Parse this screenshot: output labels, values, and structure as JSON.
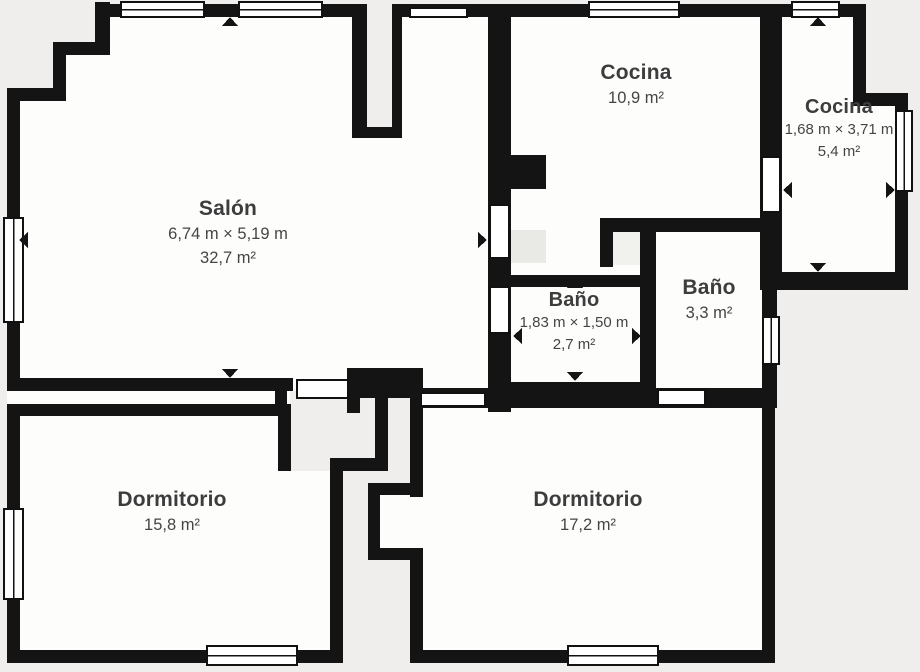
{
  "plan": {
    "title": "Floor plan",
    "background": "#efeeec",
    "room_fill": "#fdfdfc",
    "wall_color": "#141414",
    "door_fill": "#ffffff",
    "window_fill": "#ffffff",
    "outline_color": "#111111",
    "text_color": "#3d3d3d",
    "swing_fill": "#e9e9e6",
    "niche_fill": "#efeeec",
    "rooms": [
      {
        "key": "salon",
        "name": "Salón",
        "dims": "6,74 m × 5,19 m",
        "area": "32,7 m²",
        "x": 228,
        "y": 196,
        "small": false
      },
      {
        "key": "cocina-main",
        "name": "Cocina",
        "dims": "",
        "area": "10,9 m²",
        "x": 636,
        "y": 60,
        "small": false
      },
      {
        "key": "cocina-small",
        "name": "Cocina",
        "dims": "1,68 m × 3,71 m",
        "area": "5,4 m²",
        "x": 839,
        "y": 95,
        "small": true
      },
      {
        "key": "bano-small",
        "name": "Baño",
        "dims": "1,83 m × 1,50 m",
        "area": "2,7 m²",
        "x": 574,
        "y": 288,
        "small": true
      },
      {
        "key": "bano-right",
        "name": "Baño",
        "dims": "",
        "area": "3,3 m²",
        "x": 709,
        "y": 275,
        "small": false
      },
      {
        "key": "dormitorio-left",
        "name": "Dormitorio",
        "dims": "",
        "area": "15,8 m²",
        "x": 172,
        "y": 487,
        "small": false
      },
      {
        "key": "dormitorio-right",
        "name": "Dormitorio",
        "dims": "",
        "area": "17,2 m²",
        "x": 588,
        "y": 487,
        "small": false
      }
    ],
    "room_fills": [
      [
        110,
        16,
        378,
        26
      ],
      [
        66,
        42,
        422,
        59
      ],
      [
        20,
        101,
        468,
        290
      ],
      [
        7,
        391,
        283,
        13
      ],
      [
        511,
        16,
        249,
        202
      ],
      [
        511,
        218,
        130,
        176
      ],
      [
        641,
        232,
        121,
        162
      ],
      [
        782,
        16,
        71,
        256
      ],
      [
        853,
        106,
        43,
        166
      ],
      [
        20,
        414,
        258,
        236
      ],
      [
        278,
        471,
        52,
        179
      ],
      [
        423,
        406,
        339,
        244
      ],
      [
        380,
        495,
        43,
        53
      ]
    ],
    "overlays": [
      {
        "r": [
          367,
          0,
          25,
          127
        ],
        "fill": "#efeeec",
        "name": "light-well"
      },
      {
        "r": [
          511,
          230,
          35,
          33
        ],
        "fill": "#e9e9e6",
        "name": "door-swing"
      },
      {
        "r": [
          613,
          232,
          28,
          33
        ],
        "fill": "#f1f1ee",
        "name": "door-swing"
      }
    ],
    "walls": [
      [
        95,
        2,
        15,
        43
      ],
      [
        97,
        4,
        255,
        13
      ],
      [
        53,
        42,
        57,
        13
      ],
      [
        53,
        42,
        13,
        59
      ],
      [
        7,
        88,
        59,
        13
      ],
      [
        7,
        88,
        13,
        303
      ],
      [
        352,
        4,
        15,
        134
      ],
      [
        392,
        4,
        10,
        134
      ],
      [
        352,
        127,
        50,
        11
      ],
      [
        402,
        4,
        464,
        13
      ],
      [
        853,
        4,
        13,
        99
      ],
      [
        853,
        93,
        55,
        13
      ],
      [
        895,
        99,
        13,
        191
      ],
      [
        777,
        272,
        131,
        18
      ],
      [
        760,
        4,
        22,
        286
      ],
      [
        762,
        290,
        15,
        116
      ],
      [
        488,
        4,
        23,
        408
      ],
      [
        511,
        155,
        35,
        34
      ],
      [
        600,
        218,
        182,
        14
      ],
      [
        600,
        218,
        13,
        49
      ],
      [
        640,
        218,
        16,
        176
      ],
      [
        511,
        275,
        129,
        12
      ],
      [
        511,
        382,
        132,
        26
      ],
      [
        413,
        388,
        364,
        20
      ],
      [
        7,
        378,
        286,
        13
      ],
      [
        275,
        391,
        12,
        25
      ],
      [
        347,
        378,
        13,
        35
      ],
      [
        347,
        368,
        76,
        30
      ],
      [
        375,
        395,
        13,
        75
      ],
      [
        410,
        395,
        13,
        102
      ],
      [
        332,
        458,
        56,
        13
      ],
      [
        330,
        458,
        13,
        205
      ],
      [
        368,
        483,
        55,
        12
      ],
      [
        368,
        483,
        12,
        77
      ],
      [
        368,
        548,
        55,
        12
      ],
      [
        410,
        548,
        13,
        115
      ],
      [
        7,
        404,
        284,
        12
      ],
      [
        278,
        404,
        13,
        67
      ],
      [
        7,
        404,
        13,
        259
      ],
      [
        7,
        650,
        336,
        13
      ],
      [
        410,
        650,
        365,
        13
      ],
      [
        762,
        406,
        13,
        257
      ]
    ],
    "doors": [
      [
        490,
        205,
        19,
        53
      ],
      [
        490,
        287,
        19,
        46
      ],
      [
        762,
        157,
        18,
        55
      ],
      [
        658,
        390,
        47,
        15
      ],
      [
        421,
        393,
        64,
        13
      ],
      [
        297,
        380,
        51,
        18
      ]
    ],
    "windows": [
      [
        121,
        2,
        83,
        15,
        "h"
      ],
      [
        239,
        2,
        83,
        15,
        "h"
      ],
      [
        589,
        2,
        90,
        15,
        "h"
      ],
      [
        792,
        2,
        47,
        15,
        "h"
      ],
      [
        568,
        646,
        90,
        19,
        "h"
      ],
      [
        207,
        646,
        90,
        19,
        "h"
      ],
      [
        4,
        218,
        19,
        104,
        "v"
      ],
      [
        4,
        509,
        19,
        90,
        "v"
      ],
      [
        896,
        111,
        16,
        80,
        "v"
      ],
      [
        763,
        317,
        16,
        47,
        "v"
      ],
      [
        410,
        8,
        57,
        9,
        "s"
      ]
    ],
    "arrows": [
      [
        230,
        17,
        "up"
      ],
      [
        230,
        378,
        "down"
      ],
      [
        19,
        240,
        "left"
      ],
      [
        487,
        240,
        "right"
      ],
      [
        575,
        279,
        "up"
      ],
      [
        575,
        381,
        "down"
      ],
      [
        513,
        336,
        "left"
      ],
      [
        641,
        336,
        "right"
      ],
      [
        818,
        17,
        "up"
      ],
      [
        818,
        272,
        "down"
      ],
      [
        783,
        190,
        "left"
      ],
      [
        895,
        190,
        "right"
      ]
    ]
  }
}
